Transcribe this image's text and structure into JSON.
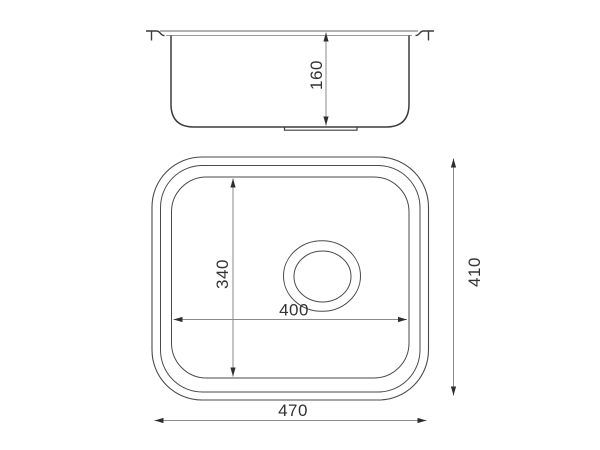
{
  "drawing": {
    "description": "Technical line drawing of a single-bowl sink: front section view above, plan view below, with dimension lines",
    "side_view": {
      "dim_depth": "160"
    },
    "plan_view": {
      "dim_inner_height": "340",
      "dim_inner_width": "400",
      "dim_outer_height": "410",
      "dim_outer_width": "470"
    },
    "colors": {
      "background": "#ffffff",
      "outline_dark": "#3c3c3c",
      "outline_plan": "#4a4a4a",
      "rim_line": "#9a9a9a",
      "dimension_line": "#8a8a8a",
      "arrowhead": "#2e2e2e",
      "text": "#333333"
    }
  }
}
